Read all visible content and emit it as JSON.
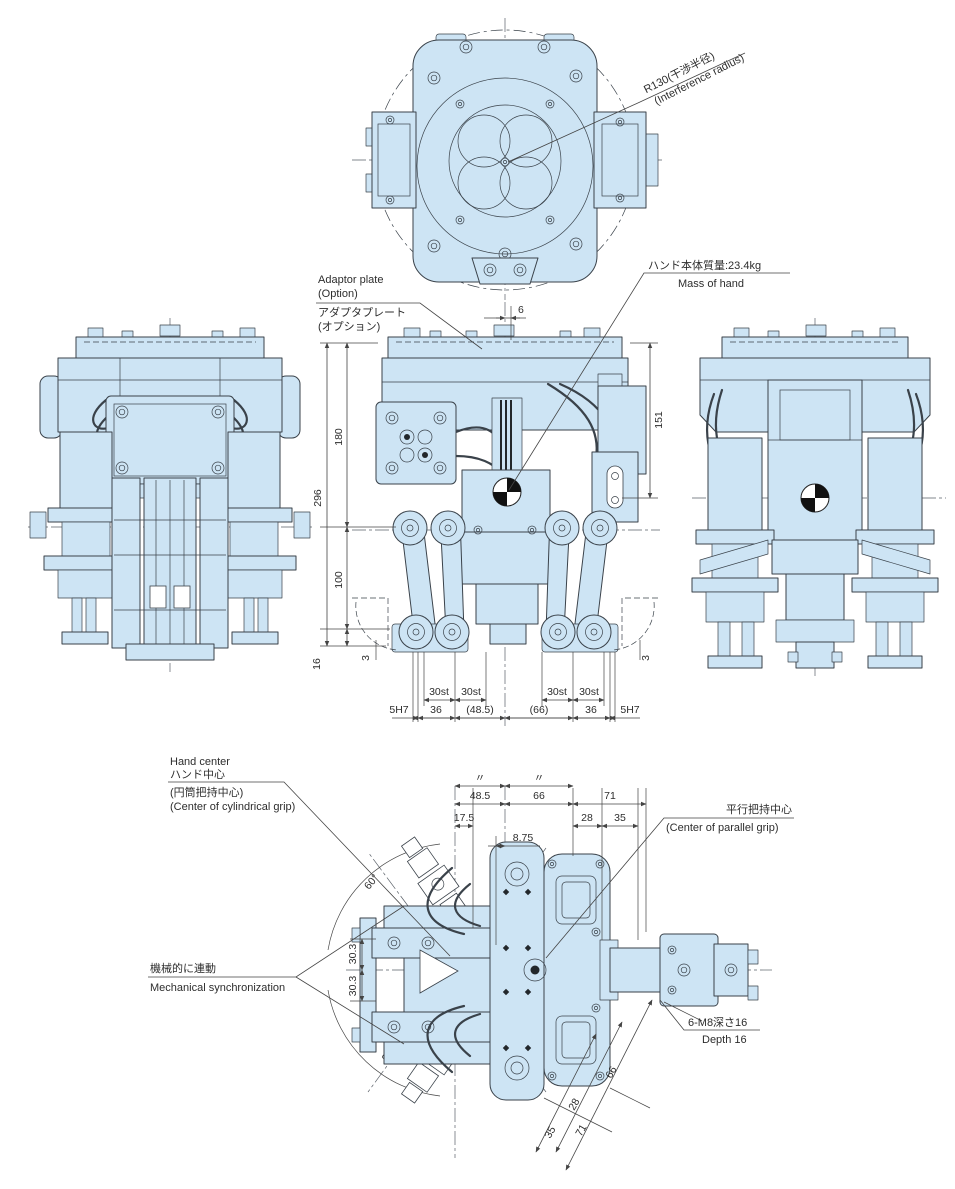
{
  "colors": {
    "part_fill": "#cde4f4",
    "outline": "#3a424a"
  },
  "top_view": {
    "interference_jp": "R130(干渉半径)",
    "interference_en": "(Interference radius)"
  },
  "front_view": {
    "adaptor_en1": "Adaptor plate",
    "adaptor_en2": "(Option)",
    "adaptor_jp1": "アダプタプレート",
    "adaptor_jp2": "(オプション)",
    "mass_jp": "ハンド本体質量:23.4kg",
    "mass_en": "Mass of hand",
    "dim_top_offset": "6",
    "dim_total_height": "296",
    "dim_upper": "180",
    "dim_lower": "100",
    "dim_base": "16",
    "dim_left_small": "3",
    "dim_right_small": "3",
    "dim_right_height": "151",
    "dim_strokes": [
      "30st",
      "30st",
      "30st",
      "30st"
    ],
    "dim_bottom": [
      "5H7",
      "36",
      "(48.5)",
      "(66)",
      "36",
      "5H7"
    ]
  },
  "bottom_view": {
    "hand_center_en1": "Hand center",
    "hand_center_jp1": "ハンド中心",
    "hand_center_jp2": "(円筒把持中心)",
    "hand_center_en2": "(Center of cylindrical grip)",
    "parallel_jp": "平行把持中心",
    "parallel_en": "(Center of parallel grip)",
    "sync_jp": "機械的に連動",
    "sync_en": "Mechanical synchronization",
    "tap_jp": "6-M8深さ16",
    "tap_en": "Depth 16",
    "dim_ditto": [
      "〃",
      "〃"
    ],
    "dim_row1": [
      "48.5",
      "66",
      "71"
    ],
    "dim_row2": [
      "17.5",
      "28",
      "35"
    ],
    "dim_offset": "8.75",
    "dim_left": [
      "30.3",
      "30.3"
    ],
    "dim_angles": [
      "60°",
      "60°"
    ],
    "dim_diag": [
      "66",
      "28",
      "35",
      "71"
    ]
  }
}
